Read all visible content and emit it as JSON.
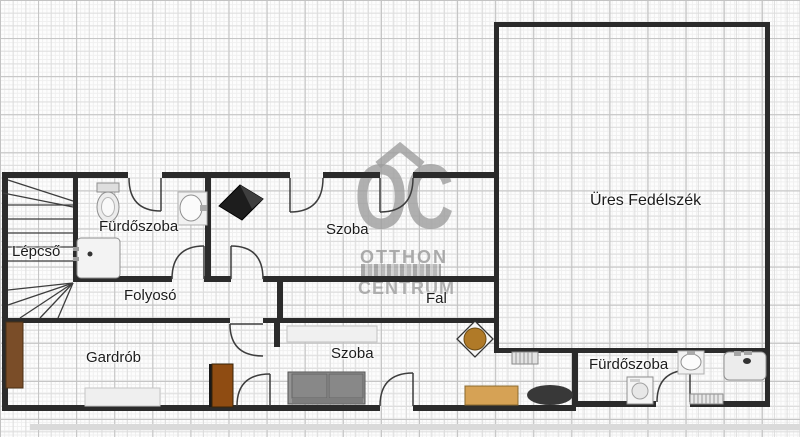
{
  "labels": {
    "lepcso": "Lépcső",
    "furdoszoba_top": "Fürdőszoba",
    "szoba_top": "Szoba",
    "folyoso": "Folyosó",
    "fal": "Fal",
    "gardrob": "Gardrób",
    "szoba_bottom": "Szoba",
    "furdoszoba_bottom": "Fürdőszoba",
    "ures_fedelszek": "Üres Fedélszék"
  },
  "watermark": {
    "logo": "OC",
    "line1": "OTTHON",
    "line2": "CENTRUM"
  },
  "colors": {
    "wall": "#2b2b2b",
    "line": "#3d3d3d",
    "grid_fine": "#efefef",
    "grid_mid": "#dddddd",
    "grid_major": "#c3c3c3",
    "label": "#1b1b1b",
    "watermark": "#9e9e9e",
    "brown_dark": "#7a4d28",
    "brown_red": "#8f4c12",
    "tan": "#d6a255",
    "table_brown": "#b07a28",
    "sofa": "#949494",
    "sofa_dark": "#7d7d7d",
    "fixture_fill": "#f1f1f1",
    "fixture_stroke": "#8f8f8f",
    "light_rect": "#efefef",
    "black_item": "#1d1d1d",
    "bottom_bar": "#dadada"
  }
}
